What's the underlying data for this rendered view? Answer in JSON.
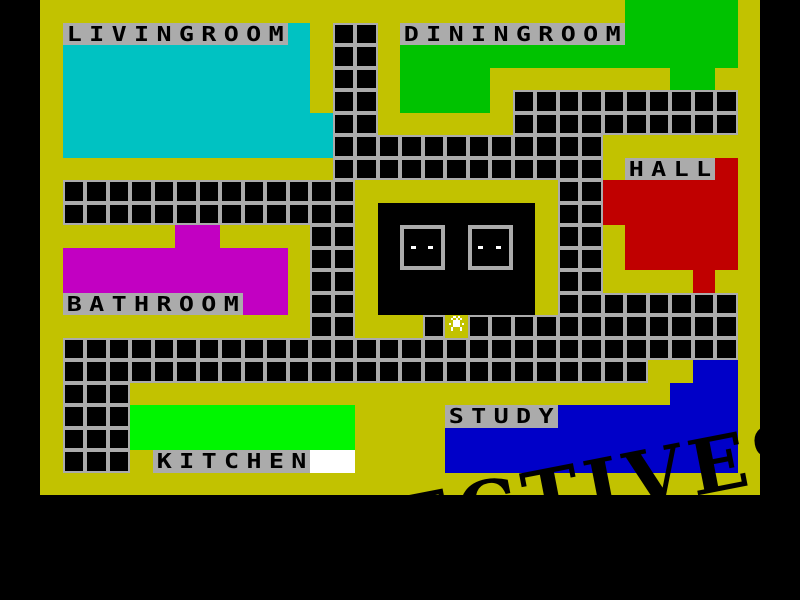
{
  "palette": {
    "background_black": "#000000",
    "floor_yellow": "#c2c200",
    "grid_grey": "#ababab",
    "label_grey": "#ababab",
    "cyan": "#00c2c2",
    "green": "#00c200",
    "bright_green": "#00f600",
    "red": "#c00000",
    "magenta": "#c200c2",
    "blue": "#0000c8",
    "white": "#ffffff",
    "dark_room_black": "#000000",
    "sprite_white": "#ffffff",
    "watermark_black": "#000000"
  },
  "map": {
    "origin_x": 40,
    "origin_y": 0,
    "cell": 22.5,
    "cols": 32,
    "rows": 22
  },
  "rooms": [
    {
      "id": "livingroom",
      "label": "LIVINGROOM",
      "color": "cyan",
      "label_pos": {
        "col": 1,
        "row": 1
      },
      "rects": [
        {
          "col": 11,
          "row": 1,
          "w": 1,
          "h": 1
        },
        {
          "col": 1,
          "row": 2,
          "w": 11,
          "h": 3
        },
        {
          "col": 1,
          "row": 5,
          "w": 12,
          "h": 2
        }
      ]
    },
    {
      "id": "diningroom",
      "label": "DININGROOM",
      "color": "green",
      "label_pos": {
        "col": 16,
        "row": 1
      },
      "rects": [
        {
          "col": 26,
          "row": 0,
          "w": 5,
          "h": 2
        },
        {
          "col": 16,
          "row": 2,
          "w": 15,
          "h": 1
        },
        {
          "col": 16,
          "row": 3,
          "w": 4,
          "h": 2
        },
        {
          "col": 28,
          "row": 3,
          "w": 2,
          "h": 1
        }
      ]
    },
    {
      "id": "hall",
      "label": "HALL",
      "color": "red",
      "label_pos": {
        "col": 26,
        "row": 7
      },
      "rects": [
        {
          "col": 30,
          "row": 7,
          "w": 1,
          "h": 1
        },
        {
          "col": 25,
          "row": 8,
          "w": 6,
          "h": 2
        },
        {
          "col": 26,
          "row": 10,
          "w": 5,
          "h": 2
        },
        {
          "col": 29,
          "row": 12,
          "w": 1,
          "h": 1
        }
      ]
    },
    {
      "id": "bathroom",
      "label": "BATHROOM",
      "color": "magenta",
      "label_pos": {
        "col": 1,
        "row": 13
      },
      "rects": [
        {
          "col": 6,
          "row": 10,
          "w": 2,
          "h": 1
        },
        {
          "col": 1,
          "row": 11,
          "w": 10,
          "h": 2
        },
        {
          "col": 9,
          "row": 13,
          "w": 2,
          "h": 1
        }
      ]
    },
    {
      "id": "kitchen",
      "label": "KITCHEN",
      "color": "bright_green",
      "label_pos": {
        "col": 5,
        "row": 20
      },
      "rects": [
        {
          "col": 4,
          "row": 18,
          "w": 10,
          "h": 2
        }
      ]
    },
    {
      "id": "study",
      "label": "STUDY",
      "color": "blue",
      "label_pos": {
        "col": 18,
        "row": 18
      },
      "rects": [
        {
          "col": 29,
          "row": 16,
          "w": 2,
          "h": 1
        },
        {
          "col": 28,
          "row": 17,
          "w": 3,
          "h": 1
        },
        {
          "col": 23,
          "row": 18,
          "w": 8,
          "h": 1
        },
        {
          "col": 18,
          "row": 19,
          "w": 13,
          "h": 2
        }
      ]
    }
  ],
  "corridors": [
    {
      "row": 1,
      "from": 13,
      "to": 14
    },
    {
      "row": 2,
      "from": 13,
      "to": 14
    },
    {
      "row": 3,
      "from": 13,
      "to": 14
    },
    {
      "row": 4,
      "from": 13,
      "to": 14
    },
    {
      "row": 4,
      "from": 21,
      "to": 30
    },
    {
      "row": 5,
      "from": 13,
      "to": 14
    },
    {
      "row": 5,
      "from": 21,
      "to": 30
    },
    {
      "row": 6,
      "from": 13,
      "to": 24
    },
    {
      "row": 7,
      "from": 13,
      "to": 24
    },
    {
      "row": 8,
      "from": 1,
      "to": 13
    },
    {
      "row": 8,
      "from": 23,
      "to": 24
    },
    {
      "row": 9,
      "from": 1,
      "to": 13
    },
    {
      "row": 9,
      "from": 23,
      "to": 24
    },
    {
      "row": 10,
      "from": 12,
      "to": 13
    },
    {
      "row": 10,
      "from": 23,
      "to": 24
    },
    {
      "row": 11,
      "from": 12,
      "to": 13
    },
    {
      "row": 11,
      "from": 23,
      "to": 24
    },
    {
      "row": 12,
      "from": 12,
      "to": 13
    },
    {
      "row": 12,
      "from": 23,
      "to": 24
    },
    {
      "row": 13,
      "from": 12,
      "to": 13
    },
    {
      "row": 13,
      "from": 23,
      "to": 30
    },
    {
      "row": 14,
      "from": 12,
      "to": 13
    },
    {
      "row": 14,
      "from": 17,
      "to": 17,
      "name": "door-tile"
    },
    {
      "row": 14,
      "from": 19,
      "to": 30
    },
    {
      "row": 15,
      "from": 1,
      "to": 30
    },
    {
      "row": 16,
      "from": 1,
      "to": 26
    },
    {
      "row": 17,
      "from": 1,
      "to": 3
    },
    {
      "row": 18,
      "from": 1,
      "to": 3
    },
    {
      "row": 19,
      "from": 1,
      "to": 3
    },
    {
      "row": 20,
      "from": 1,
      "to": 3
    }
  ],
  "dark_room": {
    "col": 15,
    "row": 9,
    "w": 7,
    "h": 5,
    "windows": [
      {
        "col": 16,
        "row": 10,
        "w": 2,
        "h": 2
      },
      {
        "col": 19,
        "row": 10,
        "w": 2,
        "h": 2
      }
    ]
  },
  "white_area": {
    "col": 12,
    "row": 20,
    "w": 2,
    "h": 1
  },
  "sprite": {
    "x": 449,
    "y": 316
  },
  "watermark": {
    "text": "DETECTIVES",
    "angle_deg": -11
  }
}
